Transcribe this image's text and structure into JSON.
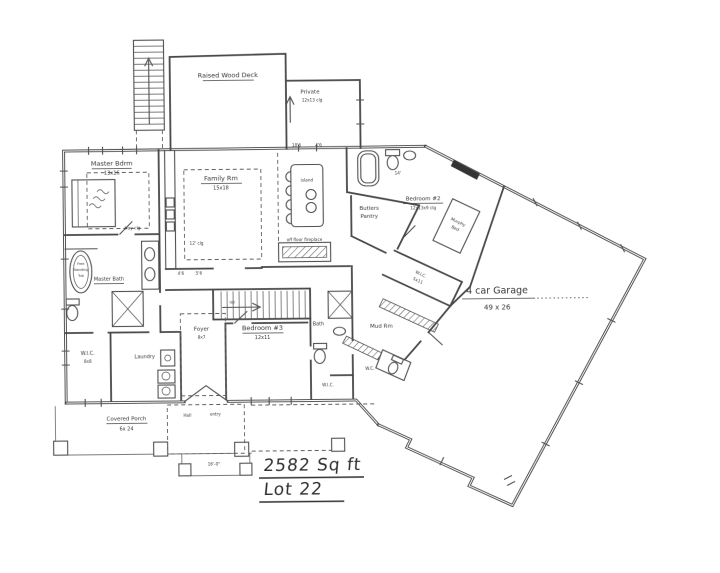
{
  "plan": {
    "sqft": "2582 Sq ft",
    "lot": "Lot 22"
  },
  "rooms": {
    "deck": {
      "name": "Raised Wood Deck"
    },
    "private": {
      "name": "Private",
      "dims": "12x13 clg"
    },
    "master_bedroom": {
      "name": "Master Bdrm",
      "dims": "13x16",
      "note": "tray clg"
    },
    "family_room": {
      "name": "Family Rm",
      "dims": "15x18",
      "note": "12' clg"
    },
    "kitchen_island": {
      "name": "island"
    },
    "fireplace": {
      "name": "off floor fireplace"
    },
    "butlers_pantry": {
      "line1": "Butlers",
      "line2": "Pantry"
    },
    "bedroom2": {
      "name": "Bedroom #2",
      "dims": "12x13x9 clg"
    },
    "murphy_bed": {
      "line1": "Murphy",
      "line2": "Bed"
    },
    "wic_mud": {
      "name": "W.I.C.",
      "dims": "5x11"
    },
    "mud_room": {
      "name": "Mud Rm"
    },
    "wc": {
      "name": "W.C."
    },
    "garage": {
      "name": "4 car Garage",
      "dims": "49 x 26"
    },
    "bath": {
      "name": "Bath"
    },
    "bedroom3": {
      "name": "Bedroom #3",
      "dims": "12x11"
    },
    "wic_bedroom3": {
      "name": "W.I.C."
    },
    "foyer": {
      "name": "Foyer",
      "dims": "8x7"
    },
    "hall": {
      "name": "Hall"
    },
    "entry": {
      "name": "entry"
    },
    "master_bath": {
      "name": "Master Bath"
    },
    "freestanding_tub": {
      "line1": "Free",
      "line2": "Standing",
      "line3": "Tub"
    },
    "wic_master": {
      "name": "W.I.C.",
      "dims": "8x8"
    },
    "laundry": {
      "name": "Laundry"
    },
    "covered_porch": {
      "name": "Covered Porch",
      "dims": "6x 24"
    },
    "stairs": {
      "up": "up"
    }
  },
  "dims": {
    "d1": "10'6",
    "d2": "4'6",
    "d3": "4'6",
    "d4": "5'6",
    "d5": "16'-0\"",
    "d6": "14'"
  },
  "colors": {
    "paper": "#ffffff",
    "ink": "#3a3a3a"
  }
}
